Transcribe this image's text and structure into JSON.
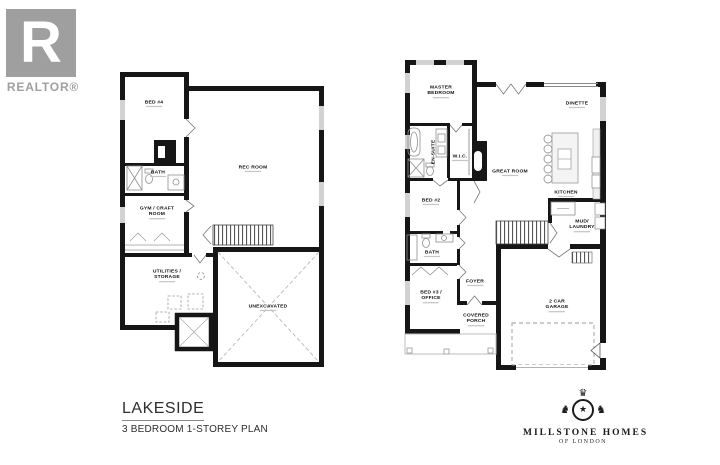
{
  "realtor": {
    "monogram": "R",
    "label": "REALTOR®"
  },
  "plans": {
    "basement": {
      "rooms": {
        "bed4": {
          "label": "BED #4"
        },
        "rec": {
          "label": "REC ROOM"
        },
        "bath": {
          "label": "BATH"
        },
        "gym": {
          "label": "GYM / CRAFT\nROOM"
        },
        "utilities": {
          "label": "UTILITIES /\nSTORAGE"
        },
        "unexcavated": {
          "label": "UNEXCAVATED"
        }
      }
    },
    "main": {
      "rooms": {
        "master": {
          "label": "MASTER\nBEDROOM"
        },
        "dinette": {
          "label": "DINETTE"
        },
        "ensuite": {
          "label": "EN-SUITE"
        },
        "wic": {
          "label": "W.I.C."
        },
        "great": {
          "label": "GREAT ROOM"
        },
        "kitchen": {
          "label": "KITCHEN"
        },
        "bed2": {
          "label": "BED #2"
        },
        "mud": {
          "label": "MUD/\nLAUNDRY"
        },
        "bath": {
          "label": "BATH"
        },
        "foyer": {
          "label": "FOYER"
        },
        "bed3": {
          "label": "BED #3 /\nOFFICE"
        },
        "garage": {
          "label": "2 CAR\nGARAGE"
        },
        "porch": {
          "label": "COVERED\nPORCH"
        }
      }
    }
  },
  "title_block": {
    "name": "LAKESIDE",
    "subtitle": "3 BEDROOM 1-STOREY PLAN"
  },
  "brand": {
    "name": "MILLSTONE HOMES",
    "sub": "OF LONDON"
  },
  "colors": {
    "wall": "#161616",
    "window": "#d2d2d2",
    "fixture": "#8e8e8e",
    "logo_gray": "#9f9f9f"
  }
}
